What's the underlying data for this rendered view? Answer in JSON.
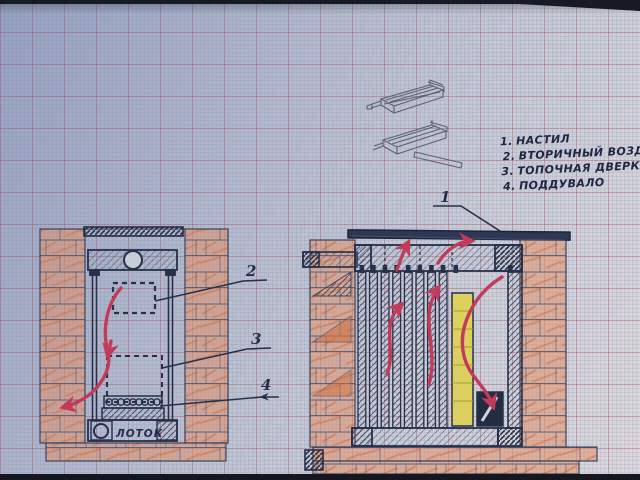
{
  "legend": {
    "items": [
      {
        "num": "1.",
        "label": "НАСТИЛ"
      },
      {
        "num": "2.",
        "label": "ВТОРИЧНЫЙ ВОЗДУХ"
      },
      {
        "num": "3.",
        "label": "ТОПОЧНАЯ ДВЕРКА"
      },
      {
        "num": "4.",
        "label": "ПОДДУВАЛО"
      }
    ]
  },
  "callouts": {
    "n1": "1",
    "n2": "2",
    "n3": "3",
    "n4": "4"
  },
  "labels": {
    "tray": "ЛОТОК"
  },
  "colors": {
    "ink": "#26304a",
    "pencil": "#5a6274",
    "brick_orange": "#e08a5e",
    "arrow_red": "#c23b5a",
    "fire_yellow": "#ddd05e",
    "paper_blue": "#c1c5d2"
  }
}
